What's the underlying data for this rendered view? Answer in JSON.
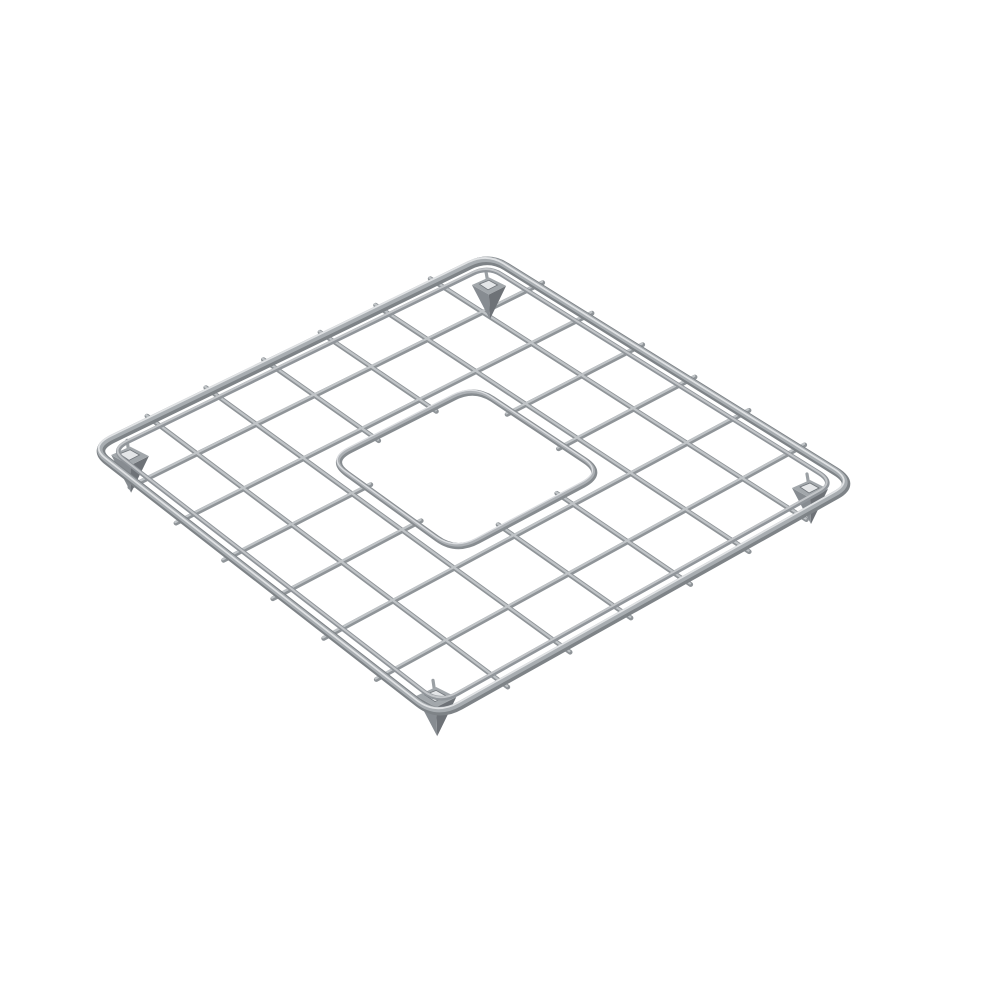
{
  "meta": {
    "description": "Isometric 3D product render of a square stainless-steel sink bottom grid: rounded-corner tubular frame, 7x7 wire lattice, square center drain opening with rounded corners, four wedge-shaped corner feet, on a plain white background",
    "background": "#ffffff"
  },
  "scene": {
    "canvas": {
      "width": 999,
      "height": 1000
    },
    "corners": {
      "top": [
        489,
        256
      ],
      "right": [
        856,
        484
      ],
      "bottom": [
        438,
        718
      ],
      "left": [
        92,
        449
      ]
    },
    "grid": {
      "divisions": 7,
      "cut_wires": [
        3,
        4
      ],
      "wire_overhang": 0.016
    },
    "opening": {
      "min": 0.322,
      "max": 0.682,
      "corner_radius": 0.052,
      "stub_inset": 0.012
    },
    "outer_frame": {
      "corner_radius": 0.05
    },
    "inner_rail": {
      "inset": 0.026,
      "corner_radius": 0.04
    },
    "feet": {
      "anchors": [
        [
          488,
          285
        ],
        [
          129,
          455
        ],
        [
          809,
          488
        ],
        [
          435,
          696
        ]
      ],
      "scales": [
        0.95,
        1.05,
        1.0,
        1.12
      ]
    },
    "palette": {
      "wire_base": "#8f9498",
      "wire_light": "#c0c4c7",
      "rail_base": "#90959a",
      "rail_light": "#c2c5c8",
      "frame_base": "#7e8387",
      "frame_mid": "#a8adb1",
      "frame_light": "#e0e2e4",
      "opening_base": "#878c90",
      "opening_mid": "#adb1b5",
      "opening_light": "#dbdde0",
      "foot_top": "#a2a7ab",
      "foot_front": "#878c91",
      "foot_side": "#6e7277",
      "foot_slot": "#e4e6e8",
      "foot_slot_edge": "#70757a",
      "hook": "#9ba0a4"
    },
    "stroke_widths": {
      "wire": 4.8,
      "wire_hi": 2.2,
      "rail": 4.6,
      "rail_hi": 2.0,
      "frame": 8.5,
      "frame_mid": 5.4,
      "frame_hi": 1.8,
      "opening": 6.2,
      "opening_mid": 3.4,
      "opening_hi": 1.3,
      "hook": 3.2
    }
  }
}
